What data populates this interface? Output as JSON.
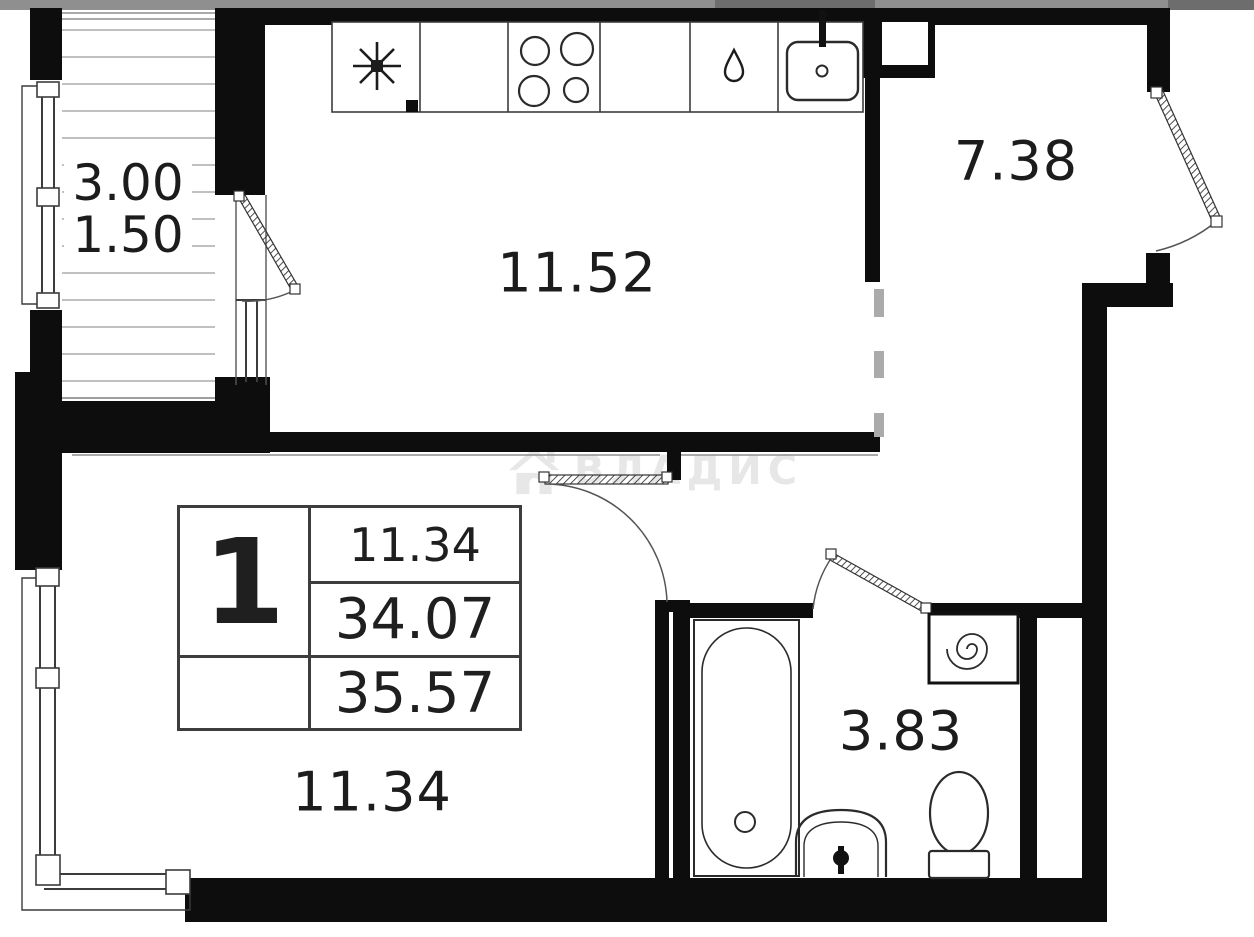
{
  "plan": {
    "watermark": "ВЛАДИС",
    "rooms": [
      {
        "id": "kitchen",
        "area": "11.52"
      },
      {
        "id": "hall",
        "area": "7.38"
      },
      {
        "id": "living",
        "area": "11.34"
      },
      {
        "id": "bathroom",
        "area": "3.83"
      }
    ],
    "balcony": {
      "area_full": "3.00",
      "area_reduced": "1.50"
    },
    "legend": {
      "rooms_count": "1",
      "living_area": "11.34",
      "apartment_area": "34.07",
      "total_area": "35.57"
    }
  },
  "colors": {
    "wall": "#0d0d0d",
    "fixture_line": "#2b2b2b",
    "hatch_line": "#9a9a9a",
    "dashed_boundary": "#ababab",
    "watermark": "#e7e7e7",
    "top_strip": "#8f8f8f",
    "top_strip_dark": "#6d6d6d"
  }
}
